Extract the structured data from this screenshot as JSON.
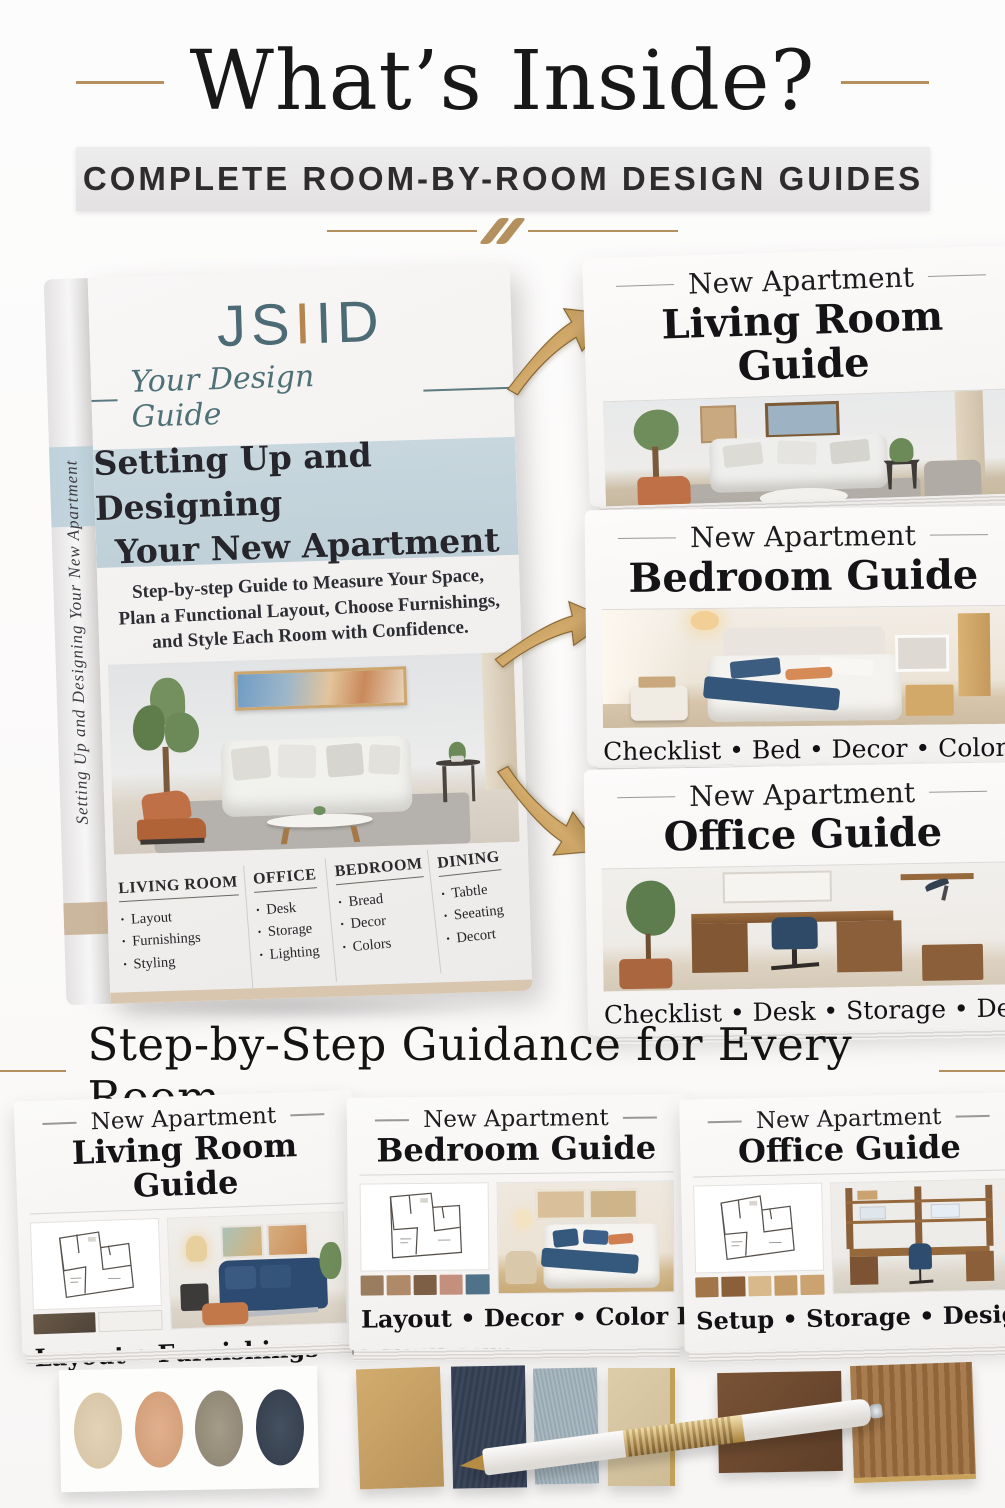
{
  "header": {
    "title": "What’s Inside?",
    "banner": "COMPLETE ROOM-BY-ROOM DESIGN GUIDES"
  },
  "book": {
    "logo_js": "JS",
    "logo_i_gold": "I",
    "logo_id": "ID",
    "tagline": "Your Design Guide",
    "title_line1": "Setting Up and Designing",
    "title_line2": "Your New Apartment",
    "subtitle_line1": "Step-by-step Guide to Measure Your Space,",
    "subtitle_line2": "Plan a Functional Layout, Choose Furnishings,",
    "subtitle_line3": "and Style Each Room with Confidence.",
    "spine_text": "Setting Up and Designing Your New Apartment",
    "columns": [
      {
        "header": "LIVING ROOM",
        "items": [
          "Layout",
          "Furnishings",
          "Styling"
        ]
      },
      {
        "header": "OFFICE",
        "items": [
          "Desk",
          "Storage",
          "Lighting"
        ]
      },
      {
        "header": "BEDROOM",
        "items": [
          "Bread",
          "Decor",
          "Colors"
        ]
      },
      {
        "header": "DINING",
        "items": [
          "Tabtle",
          "Seeating",
          "Decort"
        ]
      }
    ],
    "author_bar": "JILL SEIDNER | INTERIOR DESIGN"
  },
  "guide_cards": [
    {
      "eyebrow": "New Apartment",
      "title": "Living Room Guide",
      "tags": "Checklist • Layout • Furnishings • Styling"
    },
    {
      "eyebrow": "New Apartment",
      "title": "Bedroom Guide",
      "tags": "Checklist • Bed • Decor • Colors"
    },
    {
      "eyebrow": "New Apartment",
      "title": "Office Guide",
      "tags": "Checklist • Desk • Storage • Decor"
    }
  ],
  "section2": {
    "title": "Step-by-Step Guidance for Every Room"
  },
  "booklets": [
    {
      "eyebrow": "New Apartment",
      "title": "Living Room Guide",
      "tags": "Layout • Furnishings • Styling Tips"
    },
    {
      "eyebrow": "New Apartment",
      "title": "Bedroom Guide",
      "tags": "Layout • Decor • Color Palette"
    },
    {
      "eyebrow": "New Apartment",
      "title": "Office Guide",
      "tags": "Setup • Storage • Design Tips"
    }
  ],
  "colors": {
    "accent_gold": "#b3905e",
    "logo_teal": "#4c6b74",
    "title_band_blue": "#c5d5dd",
    "cover_beige": "#d9c6ae",
    "accent_navy": "#35455c",
    "accent_terracotta": "#bf7046"
  }
}
